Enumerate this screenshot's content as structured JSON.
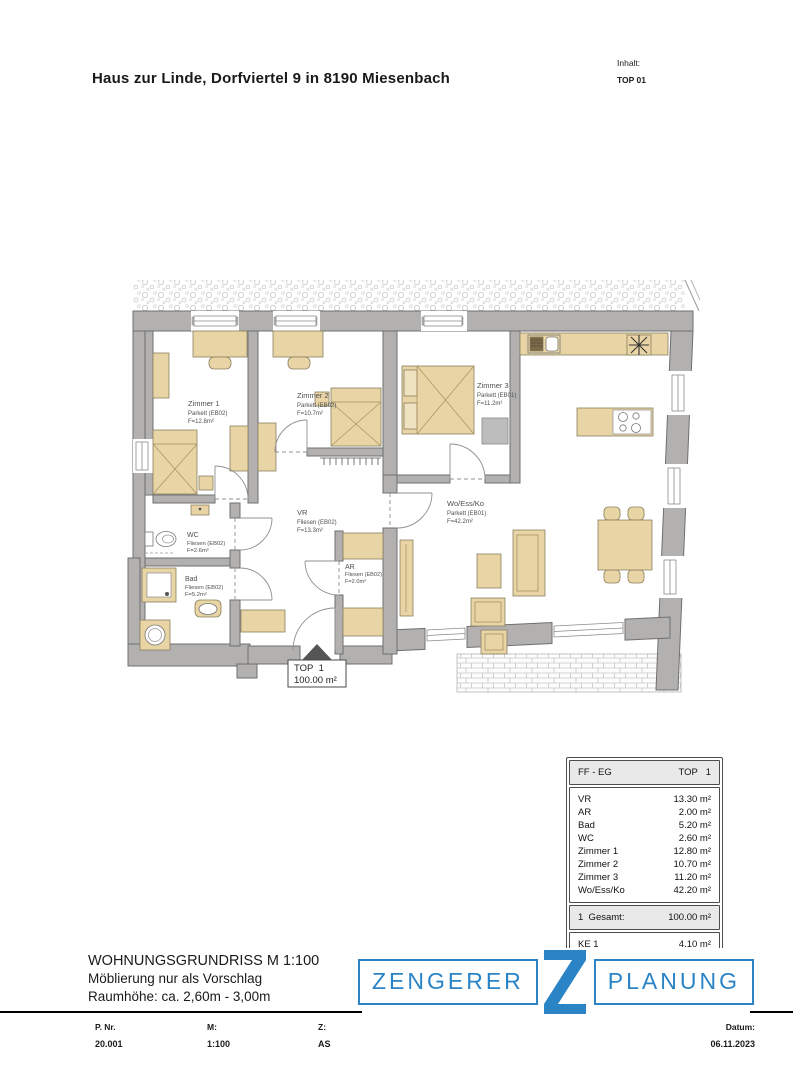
{
  "page": {
    "title": "Haus zur Linde, Dorfviertel 9 in 8190 Miesenbach",
    "inhalt_label": "Inhalt:",
    "inhalt_value": "TOP 01"
  },
  "plan": {
    "rooms": {
      "zimmer1": {
        "name": "Zimmer 1",
        "floor": "Parkett (EB02)",
        "area": "F=12.8m²"
      },
      "zimmer2": {
        "name": "Zimmer 2",
        "floor": "Parkett (EB02)",
        "area": "F=10.7m²"
      },
      "zimmer3": {
        "name": "Zimmer 3",
        "floor": "Parkett (EB01)",
        "area": "F=11.2m²"
      },
      "vr": {
        "name": "VR",
        "floor": "Fliesen (EB02)",
        "area": "F=13.3m²"
      },
      "ar": {
        "name": "AR",
        "floor": "Fliesen (EB02)",
        "area": "F=2.0m²"
      },
      "wc": {
        "name": "WC",
        "floor": "Fliesen (EB02)",
        "area": "F=2.6m²"
      },
      "bad": {
        "name": "Bad",
        "floor": "Fliesen (EB02)",
        "area": "F=5.2m²"
      },
      "woessko": {
        "name": "Wo/Ess/Ko",
        "floor": "Parkett (EB01)",
        "area": "F=42.2m²"
      }
    },
    "marker": {
      "line1": "TOP  1",
      "line2": "100.00 m²"
    }
  },
  "table": {
    "header": {
      "left": "FF - EG",
      "right": "TOP   1"
    },
    "rows": [
      [
        "VR",
        "13.30 m²"
      ],
      [
        "AR",
        "2.00 m²"
      ],
      [
        "Bad",
        "5.20 m²"
      ],
      [
        "WC",
        "2.60 m²"
      ],
      [
        "Zimmer 1",
        "12.80 m²"
      ],
      [
        "Zimmer 2",
        "10.70 m²"
      ],
      [
        "Zimmer 3",
        "11.20 m²"
      ],
      [
        "Wo/Ess/Ko",
        "42.20 m²"
      ]
    ],
    "total": {
      "label": "1  Gesamt:",
      "value": "100.00 m²"
    },
    "extra": {
      "label": "KE 1",
      "value": "4.10 m²"
    }
  },
  "footer": {
    "line1": "WOHNUNGSGRUNDRISS M 1:100",
    "line2": "Möblierung nur als Vorschlag",
    "line3": "Raumhöhe: ca. 2,60m - 3,00m",
    "logo": {
      "left": "ZENGERER",
      "z": "Z",
      "right": "PLANUNG"
    },
    "fields": [
      {
        "label": "P. Nr.",
        "value": "20.001"
      },
      {
        "label": "M:",
        "value": "1:100"
      },
      {
        "label": "Z:",
        "value": "AS"
      },
      {
        "label": "Datum:",
        "value": "06.11.2023"
      }
    ]
  },
  "colors": {
    "logo_blue": "#2a84c5",
    "wall_gray": "#b2b1b0",
    "furniture_beige": "#e8d4a4",
    "table_header_gray": "#e9e9e9"
  }
}
